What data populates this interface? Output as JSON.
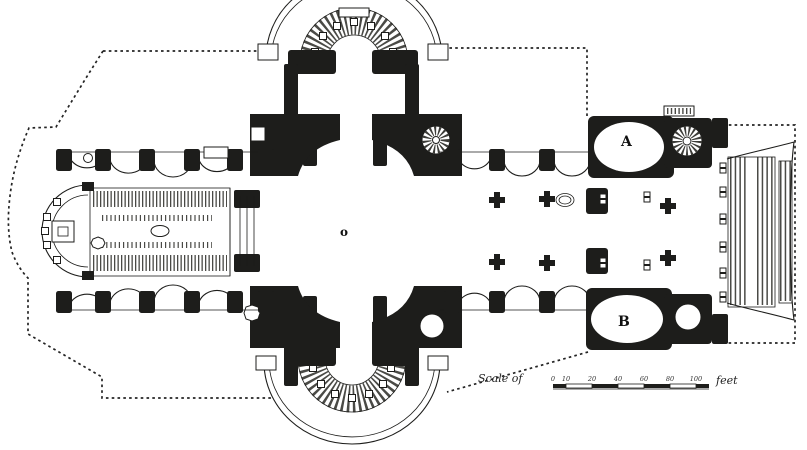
{
  "plan": {
    "ink_color": "#1d1d1b",
    "paper_color": "#ffffff",
    "labels": {
      "chapel_a": "A",
      "chapel_b": "B",
      "dome_center": "o"
    },
    "scale_bar": {
      "prefix": "Scale of",
      "unit": "feet",
      "ticks": [
        "0",
        "10",
        "20",
        "40",
        "60",
        "80",
        "100"
      ]
    }
  }
}
